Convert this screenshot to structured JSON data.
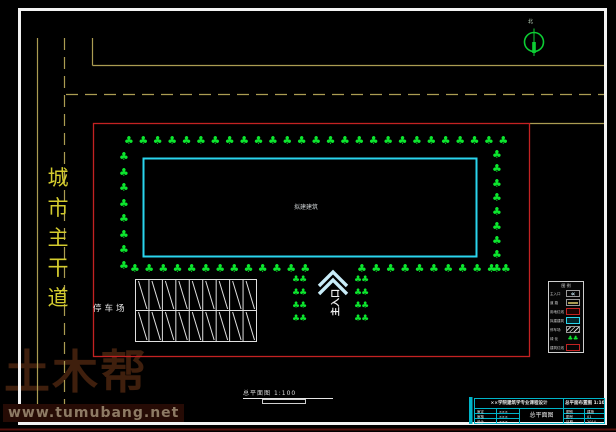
{
  "watermark": {
    "brand": "土木帮",
    "site": "www.tumubang.net"
  },
  "road": {
    "label": "城市主干道"
  },
  "north": {
    "label": "北"
  },
  "building": {
    "label": "拟建建筑"
  },
  "parking": {
    "label": "停车场"
  },
  "entrance": {
    "label": "主入口"
  },
  "scale_note": {
    "title": "总平面图",
    "scale": "1:100"
  },
  "greenery": {
    "tree_glyph": "♣",
    "shrub_glyph": "♣♣"
  },
  "legend": {
    "title": "图 例",
    "rows": [
      {
        "label": "主入口",
        "type": "entrance"
      },
      {
        "label": "道 路",
        "type": "road"
      },
      {
        "label": "用地红线",
        "type": "boundary"
      },
      {
        "label": "拟建建筑",
        "type": "building"
      },
      {
        "label": "停车场",
        "type": "parking"
      },
      {
        "label": "绿 化",
        "type": "greenery"
      },
      {
        "label": "建筑红线",
        "type": "wall"
      }
    ]
  },
  "titleblock": {
    "header_left": "××学院建筑学专业课程设计",
    "header_right": "总平面布置图 1:100",
    "left_rows": [
      [
        "审定",
        "×××"
      ],
      [
        "审核",
        "×××"
      ],
      [
        "设计",
        "×××"
      ]
    ],
    "right_rows": [
      [
        "图别",
        "建施"
      ],
      [
        "图号",
        "01"
      ],
      [
        "日期",
        "2014"
      ]
    ],
    "center": "总平面图"
  },
  "colors": {
    "road": "#ab9c52",
    "road_text": "#d4cc2e",
    "boundary": "#c32222",
    "building_outline": "#2ad5ee",
    "tree": "#0ce62e",
    "arrow": "#c8ecf8",
    "frame": "#f2f2f2",
    "titleblock": "#00b4c8"
  }
}
